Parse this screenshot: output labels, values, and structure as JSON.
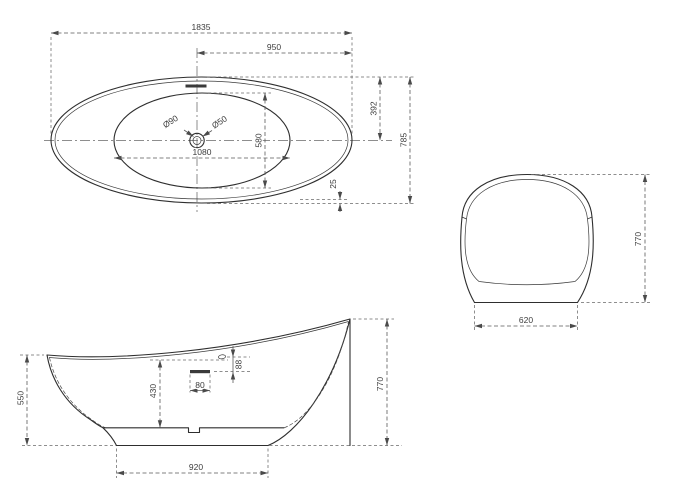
{
  "views": {
    "top": {
      "dims": {
        "overall_length": "1835",
        "right_half_length": "950",
        "top_half_width": "392",
        "overall_width": "785",
        "basin_width": "580",
        "basin_length": "1080",
        "rim_lip": "25",
        "drain_outer_dia": "Ø90",
        "drain_inner_dia": "Ø50"
      }
    },
    "side": {
      "dims": {
        "front_rim_height": "550",
        "inner_depth": "430",
        "overflow_length": "80",
        "overflow_below_rim": "88",
        "back_rim_height": "770",
        "base_length": "920"
      }
    },
    "end": {
      "dims": {
        "overall_height": "770",
        "base_width": "620"
      }
    }
  }
}
